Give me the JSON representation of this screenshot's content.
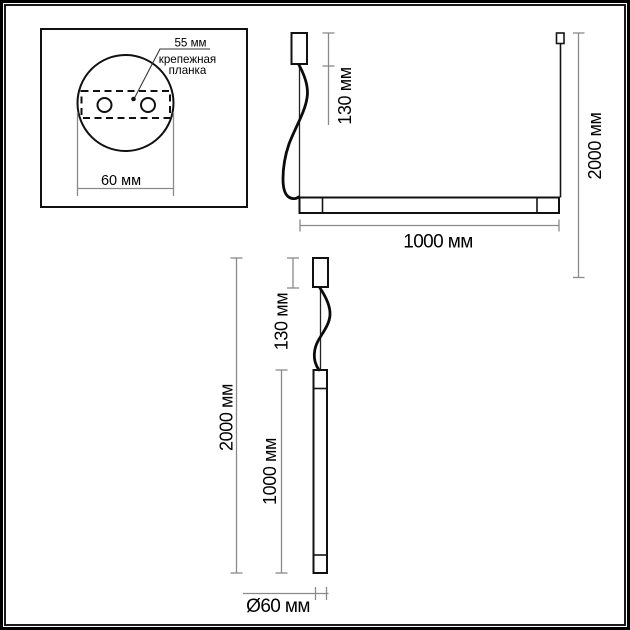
{
  "colors": {
    "line": "#111111",
    "dimension_line": "#8a8a8a",
    "text": "#000000",
    "background": "#ffffff",
    "frame": "#000000"
  },
  "mount_detail_panel": {
    "hole_spacing_label": "55 мм",
    "mounting_plate_label_line1": "крепежная",
    "mounting_plate_label_line2": "планка",
    "canopy_width_label": "60 мм"
  },
  "horizontal_fixture_view": {
    "canopy_height_label": "130 мм",
    "max_suspension_label": "2000 мм",
    "bar_length_label": "1000 мм"
  },
  "vertical_fixture_view": {
    "overall_height_label": "2000 мм",
    "canopy_height_label": "130 мм",
    "tube_length_label": "1000 мм",
    "tube_diameter_label": "Ø60 мм"
  }
}
